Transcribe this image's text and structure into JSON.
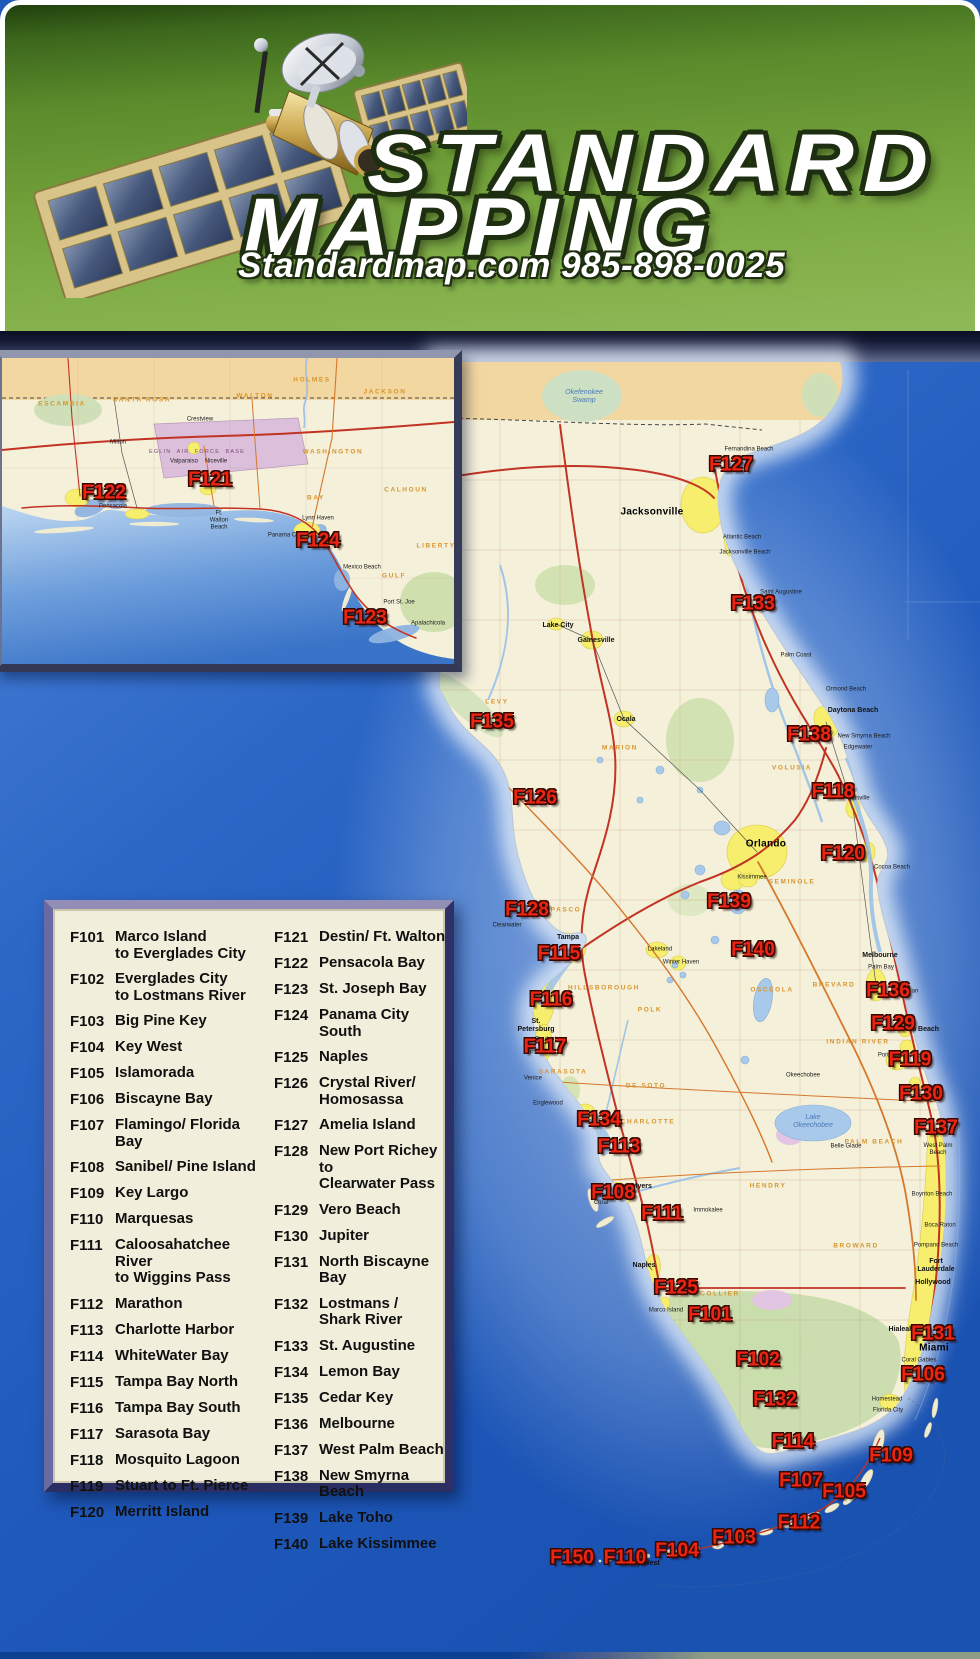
{
  "header": {
    "title_line1": "STANDARD",
    "title_line2": "MAPPING",
    "contact": "Standardmap.com 985-898-0025",
    "logo": "satellite-icon"
  },
  "colors": {
    "label_red": "#ee2413",
    "header_green": "#6f9c3c",
    "ocean_blue": "#1e58ba",
    "land_cream": "#f4f0da",
    "georgia_band": "#f3d7a0",
    "urban_yellow": "#f6ee6c",
    "park_green": "#cfe0ae",
    "water_blue": "#a9c9ea",
    "road_red": "#c23324",
    "road_orange": "#d4782c",
    "legend_bg": "#f1eedb",
    "frame_navy": "#46498a"
  },
  "legend": {
    "left": [
      {
        "code": "F101",
        "name": "Marco Island\nto Everglades City"
      },
      {
        "code": "F102",
        "name": "Everglades City\nto Lostmans River"
      },
      {
        "code": "F103",
        "name": "Big Pine Key"
      },
      {
        "code": "F104",
        "name": "Key West"
      },
      {
        "code": "F105",
        "name": "Islamorada"
      },
      {
        "code": "F106",
        "name": "Biscayne Bay"
      },
      {
        "code": "F107",
        "name": "Flamingo/ Florida Bay"
      },
      {
        "code": "F108",
        "name": "Sanibel/ Pine Island"
      },
      {
        "code": "F109",
        "name": "Key Largo"
      },
      {
        "code": "F110",
        "name": "Marquesas"
      },
      {
        "code": "F111",
        "name": "Caloosahatchee River\nto Wiggins Pass"
      },
      {
        "code": "F112",
        "name": "Marathon"
      },
      {
        "code": "F113",
        "name": "Charlotte Harbor"
      },
      {
        "code": "F114",
        "name": "WhiteWater Bay"
      },
      {
        "code": "F115",
        "name": "Tampa Bay North"
      },
      {
        "code": "F116",
        "name": "Tampa Bay South"
      },
      {
        "code": "F117",
        "name": "Sarasota Bay"
      },
      {
        "code": "F118",
        "name": "Mosquito Lagoon"
      },
      {
        "code": "F119",
        "name": "Stuart to Ft. Pierce"
      },
      {
        "code": "F120",
        "name": "Merritt Island"
      }
    ],
    "right": [
      {
        "code": "F121",
        "name": "Destin/ Ft. Walton"
      },
      {
        "code": "F122",
        "name": "Pensacola Bay"
      },
      {
        "code": "F123",
        "name": "St. Joseph Bay"
      },
      {
        "code": "F124",
        "name": "Panama City South"
      },
      {
        "code": "F125",
        "name": "Naples"
      },
      {
        "code": "F126",
        "name": "Crystal River/\nHomosassa"
      },
      {
        "code": "F127",
        "name": "Amelia Island"
      },
      {
        "code": "F128",
        "name": "New Port Richey to\nClearwater Pass"
      },
      {
        "code": "F129",
        "name": "Vero Beach"
      },
      {
        "code": "F130",
        "name": "Jupiter"
      },
      {
        "code": "F131",
        "name": "North Biscayne Bay"
      },
      {
        "code": "F132",
        "name": "Lostmans /\nShark River"
      },
      {
        "code": "F133",
        "name": "St. Augustine"
      },
      {
        "code": "F134",
        "name": "Lemon Bay"
      },
      {
        "code": "F135",
        "name": "Cedar Key"
      },
      {
        "code": "F136",
        "name": "Melbourne"
      },
      {
        "code": "F137",
        "name": "West Palm Beach"
      },
      {
        "code": "F138",
        "name": "New Smyrna Beach"
      },
      {
        "code": "F139",
        "name": "Lake Toho"
      },
      {
        "code": "F140",
        "name": "Lake Kissimmee"
      }
    ]
  },
  "map_labels": [
    {
      "code": "F122",
      "x": 104,
      "y": 493,
      "area": "inset"
    },
    {
      "code": "F121",
      "x": 210,
      "y": 480,
      "area": "inset"
    },
    {
      "code": "F124",
      "x": 318,
      "y": 541,
      "area": "inset"
    },
    {
      "code": "F123",
      "x": 365,
      "y": 618,
      "area": "inset"
    },
    {
      "code": "F127",
      "x": 731,
      "y": 465,
      "area": "main"
    },
    {
      "code": "F133",
      "x": 753,
      "y": 604,
      "area": "main"
    },
    {
      "code": "F135",
      "x": 492,
      "y": 722,
      "area": "main"
    },
    {
      "code": "F138",
      "x": 809,
      "y": 735,
      "area": "main"
    },
    {
      "code": "F126",
      "x": 535,
      "y": 798,
      "area": "main"
    },
    {
      "code": "F118",
      "x": 833,
      "y": 792,
      "area": "main"
    },
    {
      "code": "F120",
      "x": 843,
      "y": 854,
      "area": "main"
    },
    {
      "code": "F139",
      "x": 729,
      "y": 902,
      "area": "main"
    },
    {
      "code": "F128",
      "x": 527,
      "y": 910,
      "area": "main"
    },
    {
      "code": "F115",
      "x": 559,
      "y": 954,
      "area": "main"
    },
    {
      "code": "F140",
      "x": 753,
      "y": 950,
      "area": "main"
    },
    {
      "code": "F136",
      "x": 888,
      "y": 991,
      "area": "main"
    },
    {
      "code": "F116",
      "x": 551,
      "y": 1000,
      "area": "main"
    },
    {
      "code": "F129",
      "x": 893,
      "y": 1024,
      "area": "main"
    },
    {
      "code": "F117",
      "x": 545,
      "y": 1047,
      "area": "main"
    },
    {
      "code": "F119",
      "x": 910,
      "y": 1060,
      "area": "main"
    },
    {
      "code": "F130",
      "x": 921,
      "y": 1094,
      "area": "main"
    },
    {
      "code": "F134",
      "x": 599,
      "y": 1120,
      "area": "main"
    },
    {
      "code": "F137",
      "x": 936,
      "y": 1128,
      "area": "main"
    },
    {
      "code": "F113",
      "x": 619,
      "y": 1147,
      "area": "main"
    },
    {
      "code": "F108",
      "x": 613,
      "y": 1193,
      "area": "main"
    },
    {
      "code": "F111",
      "x": 662,
      "y": 1214,
      "area": "main"
    },
    {
      "code": "F125",
      "x": 676,
      "y": 1288,
      "area": "main"
    },
    {
      "code": "F101",
      "x": 710,
      "y": 1315,
      "area": "main"
    },
    {
      "code": "F131",
      "x": 933,
      "y": 1334,
      "area": "main"
    },
    {
      "code": "F102",
      "x": 758,
      "y": 1360,
      "area": "main"
    },
    {
      "code": "F106",
      "x": 923,
      "y": 1375,
      "area": "main"
    },
    {
      "code": "F132",
      "x": 775,
      "y": 1400,
      "area": "main"
    },
    {
      "code": "F114",
      "x": 793,
      "y": 1442,
      "area": "main"
    },
    {
      "code": "F109",
      "x": 891,
      "y": 1456,
      "area": "main"
    },
    {
      "code": "F107",
      "x": 801,
      "y": 1481,
      "area": "main"
    },
    {
      "code": "F105",
      "x": 844,
      "y": 1492,
      "area": "main"
    },
    {
      "code": "F112",
      "x": 799,
      "y": 1523,
      "area": "main"
    },
    {
      "code": "F103",
      "x": 734,
      "y": 1538,
      "area": "main"
    },
    {
      "code": "F104",
      "x": 677,
      "y": 1551,
      "area": "main"
    },
    {
      "code": "F110",
      "x": 625,
      "y": 1558,
      "area": "main"
    },
    {
      "code": "F150",
      "x": 572,
      "y": 1558,
      "area": "main"
    }
  ],
  "map_text": {
    "cities": [
      {
        "t": "Jacksonville",
        "x": 652,
        "y": 512,
        "c": "big"
      },
      {
        "t": "Orlando",
        "x": 766,
        "y": 844,
        "c": "big"
      },
      {
        "t": "Miami",
        "x": 934,
        "y": 1348,
        "c": "big"
      },
      {
        "t": "St.\nPetersburg",
        "x": 536,
        "y": 1026,
        "c": "med"
      },
      {
        "t": "Tampa",
        "x": 568,
        "y": 938,
        "c": "med"
      },
      {
        "t": "Daytona Beach",
        "x": 853,
        "y": 711,
        "c": "med"
      },
      {
        "t": "Fort\nLauderdale",
        "x": 936,
        "y": 1266,
        "c": "med"
      },
      {
        "t": "Hollywood",
        "x": 933,
        "y": 1283,
        "c": "med"
      },
      {
        "t": "Key West",
        "x": 644,
        "y": 1564,
        "c": "med"
      },
      {
        "t": "Gainesville",
        "x": 596,
        "y": 641,
        "c": "med"
      },
      {
        "t": "Ocala",
        "x": 626,
        "y": 720,
        "c": "med"
      },
      {
        "t": "Lake City",
        "x": 558,
        "y": 626,
        "c": "med"
      },
      {
        "t": "Fort Myers",
        "x": 634,
        "y": 1187,
        "c": "med"
      },
      {
        "t": "Cape\nCoral",
        "x": 601,
        "y": 1200,
        "c": ""
      },
      {
        "t": "Naples",
        "x": 644,
        "y": 1266,
        "c": "med"
      },
      {
        "t": "Melbourne",
        "x": 880,
        "y": 956,
        "c": "med"
      },
      {
        "t": "Vero Beach",
        "x": 920,
        "y": 1030,
        "c": "med"
      },
      {
        "t": "Hialeah",
        "x": 901,
        "y": 1330,
        "c": "med"
      },
      {
        "t": "Homestead",
        "x": 887,
        "y": 1400,
        "c": ""
      },
      {
        "t": "Key Largo",
        "x": 887,
        "y": 1462,
        "c": ""
      },
      {
        "t": "Titusville",
        "x": 858,
        "y": 799,
        "c": ""
      },
      {
        "t": "Clearwater",
        "x": 507,
        "y": 926,
        "c": ""
      },
      {
        "t": "Sarasota",
        "x": 536,
        "y": 1053,
        "c": ""
      },
      {
        "t": "Bradenton",
        "x": 549,
        "y": 1040,
        "c": ""
      },
      {
        "t": "Punta Gorda",
        "x": 598,
        "y": 1122,
        "c": ""
      },
      {
        "t": "Kissimmee",
        "x": 752,
        "y": 878,
        "c": ""
      },
      {
        "t": "Lakeland",
        "x": 660,
        "y": 950,
        "c": ""
      },
      {
        "t": "Fernandina Beach",
        "x": 749,
        "y": 450,
        "c": ""
      },
      {
        "t": "Atlantic Beach",
        "x": 742,
        "y": 538,
        "c": ""
      },
      {
        "t": "Jacksonville Beach",
        "x": 745,
        "y": 553,
        "c": ""
      },
      {
        "t": "Saint Augustine",
        "x": 781,
        "y": 593,
        "c": ""
      },
      {
        "t": "Palm Coast",
        "x": 796,
        "y": 656,
        "c": ""
      },
      {
        "t": "Ormond Beach",
        "x": 846,
        "y": 690,
        "c": ""
      },
      {
        "t": "New Smyrna Beach",
        "x": 864,
        "y": 737,
        "c": ""
      },
      {
        "t": "Edgewater",
        "x": 858,
        "y": 748,
        "c": ""
      },
      {
        "t": "Cocoa Beach",
        "x": 892,
        "y": 868,
        "c": ""
      },
      {
        "t": "Palm Bay",
        "x": 881,
        "y": 968,
        "c": ""
      },
      {
        "t": "Sebastian",
        "x": 905,
        "y": 992,
        "c": ""
      },
      {
        "t": "Port Saint Lucie",
        "x": 899,
        "y": 1056,
        "c": ""
      },
      {
        "t": "Hobe Sound",
        "x": 923,
        "y": 1097,
        "c": ""
      },
      {
        "t": "West Palm\nBeach",
        "x": 938,
        "y": 1150,
        "c": ""
      },
      {
        "t": "Boynton Beach",
        "x": 932,
        "y": 1195,
        "c": ""
      },
      {
        "t": "Boca Raton",
        "x": 940,
        "y": 1226,
        "c": ""
      },
      {
        "t": "Pompano Beach",
        "x": 936,
        "y": 1246,
        "c": ""
      },
      {
        "t": "Coral Gables",
        "x": 919,
        "y": 1361,
        "c": ""
      },
      {
        "t": "Kendall",
        "x": 911,
        "y": 1373,
        "c": ""
      },
      {
        "t": "Florida City",
        "x": 888,
        "y": 1411,
        "c": ""
      },
      {
        "t": "Marco Island",
        "x": 666,
        "y": 1311,
        "c": ""
      },
      {
        "t": "Immokalee",
        "x": 708,
        "y": 1211,
        "c": ""
      },
      {
        "t": "Belle Glade",
        "x": 846,
        "y": 1147,
        "c": ""
      },
      {
        "t": "Winter Haven",
        "x": 681,
        "y": 963,
        "c": ""
      },
      {
        "t": "Okeechobee",
        "x": 803,
        "y": 1076,
        "c": ""
      },
      {
        "t": "Venice",
        "x": 533,
        "y": 1079,
        "c": ""
      },
      {
        "t": "Englewood",
        "x": 548,
        "y": 1104,
        "c": ""
      },
      {
        "t": "Marathon",
        "x": 791,
        "y": 1517,
        "c": ""
      }
    ],
    "counties": [
      {
        "t": "LEVY",
        "x": 497,
        "y": 702
      },
      {
        "t": "MARION",
        "x": 620,
        "y": 748
      },
      {
        "t": "VOLUSIA",
        "x": 792,
        "y": 768
      },
      {
        "t": "SEMINOLE",
        "x": 792,
        "y": 882
      },
      {
        "t": "PASCO",
        "x": 566,
        "y": 910
      },
      {
        "t": "HILLSBOROUGH",
        "x": 604,
        "y": 988
      },
      {
        "t": "POLK",
        "x": 650,
        "y": 1010
      },
      {
        "t": "OSCEOLA",
        "x": 772,
        "y": 990
      },
      {
        "t": "BREVARD",
        "x": 834,
        "y": 985
      },
      {
        "t": "SARASOTA",
        "x": 563,
        "y": 1072
      },
      {
        "t": "DE SOTO",
        "x": 646,
        "y": 1086
      },
      {
        "t": "CHARLOTTE",
        "x": 648,
        "y": 1122
      },
      {
        "t": "INDIAN RIVER",
        "x": 858,
        "y": 1042
      },
      {
        "t": "HENDRY",
        "x": 768,
        "y": 1186
      },
      {
        "t": "PALM BEACH",
        "x": 874,
        "y": 1142
      },
      {
        "t": "BROWARD",
        "x": 856,
        "y": 1246
      },
      {
        "t": "COLLIER",
        "x": 720,
        "y": 1294
      }
    ],
    "water_labels": [
      {
        "t": "Lake\nOkeechobee",
        "x": 813,
        "y": 1122
      },
      {
        "t": "Okefenokee\nSwamp",
        "x": 584,
        "y": 397
      }
    ],
    "area_labels": [
      {
        "t": "EGLIN  AIR  FORCE  BASE",
        "x": 197,
        "y": 452
      }
    ],
    "inset_cities": [
      {
        "t": "Pensacola",
        "x": 113,
        "y": 507,
        "c": ""
      },
      {
        "t": "Milton",
        "x": 118,
        "y": 443,
        "c": ""
      },
      {
        "t": "Crestview",
        "x": 200,
        "y": 420,
        "c": ""
      },
      {
        "t": "Valparaiso",
        "x": 184,
        "y": 462,
        "c": ""
      },
      {
        "t": "Niceville",
        "x": 216,
        "y": 462,
        "c": ""
      },
      {
        "t": "Ft.\nWalton\nBeach",
        "x": 219,
        "y": 521,
        "c": ""
      },
      {
        "t": "Panama City",
        "x": 285,
        "y": 536,
        "c": ""
      },
      {
        "t": "Lynn Haven",
        "x": 318,
        "y": 519,
        "c": ""
      },
      {
        "t": "Mexico Beach",
        "x": 362,
        "y": 568,
        "c": ""
      },
      {
        "t": "Port St. Joe",
        "x": 399,
        "y": 603,
        "c": ""
      },
      {
        "t": "Apalachicola",
        "x": 428,
        "y": 624,
        "c": ""
      }
    ],
    "inset_counties": [
      {
        "t": "ESCAMBIA",
        "x": 62,
        "y": 404
      },
      {
        "t": "SANTA ROSA",
        "x": 142,
        "y": 400
      },
      {
        "t": "WALTON",
        "x": 255,
        "y": 396
      },
      {
        "t": "HOLMES",
        "x": 312,
        "y": 380
      },
      {
        "t": "JACKSON",
        "x": 385,
        "y": 392
      },
      {
        "t": "WASHINGTON",
        "x": 333,
        "y": 452
      },
      {
        "t": "BAY",
        "x": 316,
        "y": 498
      },
      {
        "t": "CALHOUN",
        "x": 406,
        "y": 490
      },
      {
        "t": "GULF",
        "x": 394,
        "y": 576
      },
      {
        "t": "LIBERTY",
        "x": 436,
        "y": 546
      }
    ]
  }
}
